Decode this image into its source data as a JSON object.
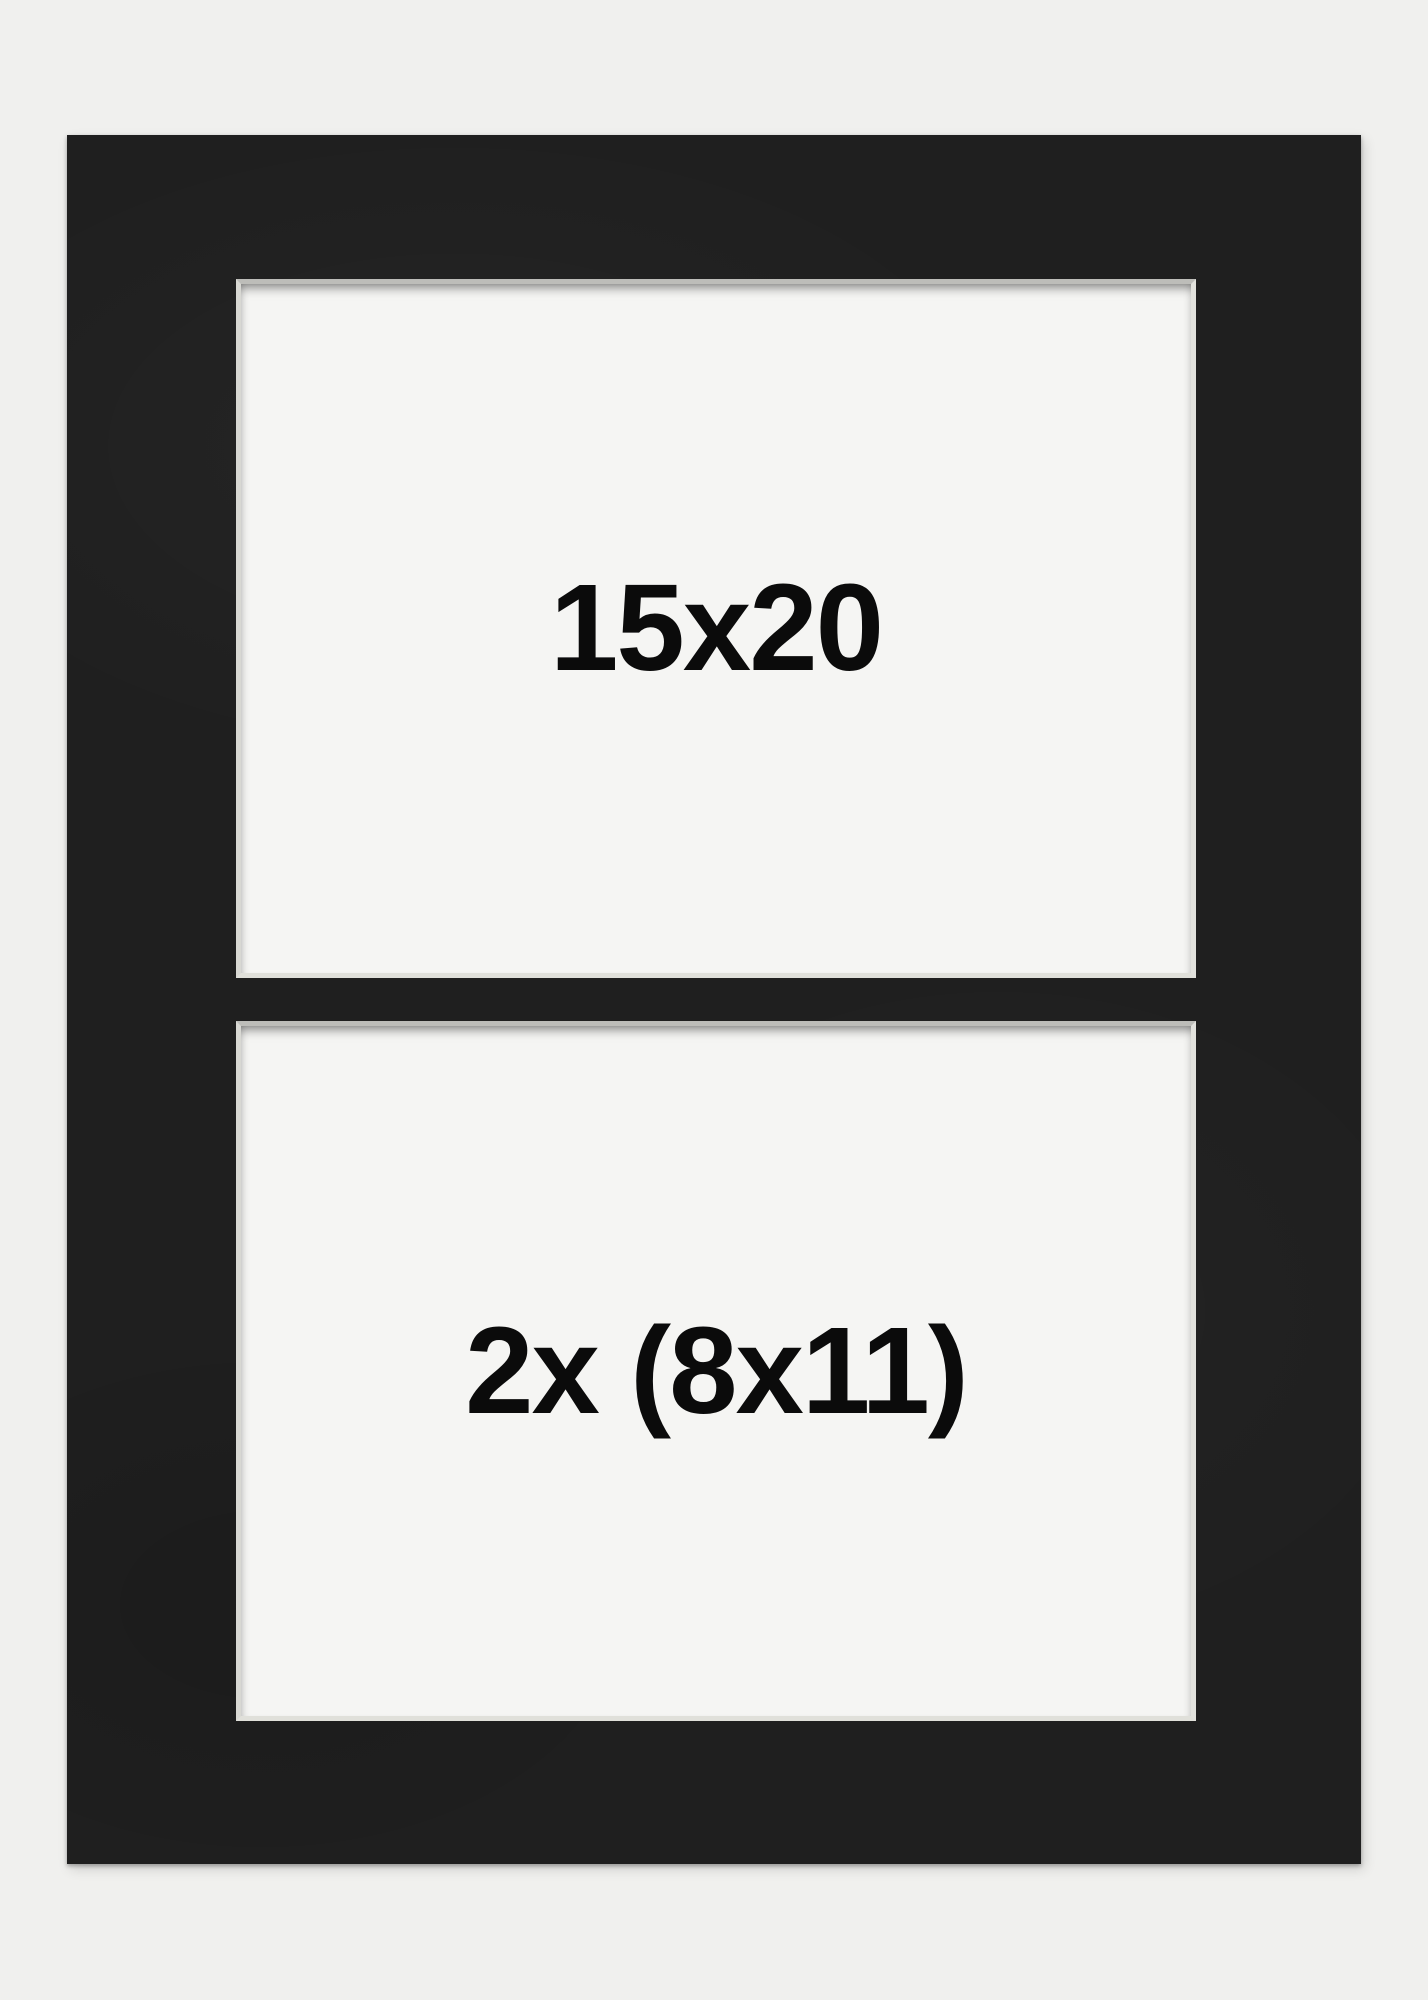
{
  "page": {
    "background_color": "#f0f0ee"
  },
  "mat_board": {
    "color": "#1f1f1f",
    "bevel_color": "#dcdcd7",
    "opening_color": "#f5f5f3",
    "label_color": "#0b0b0b",
    "openings": [
      {
        "label": "15x20"
      },
      {
        "label": "2x (8x11)"
      }
    ]
  }
}
